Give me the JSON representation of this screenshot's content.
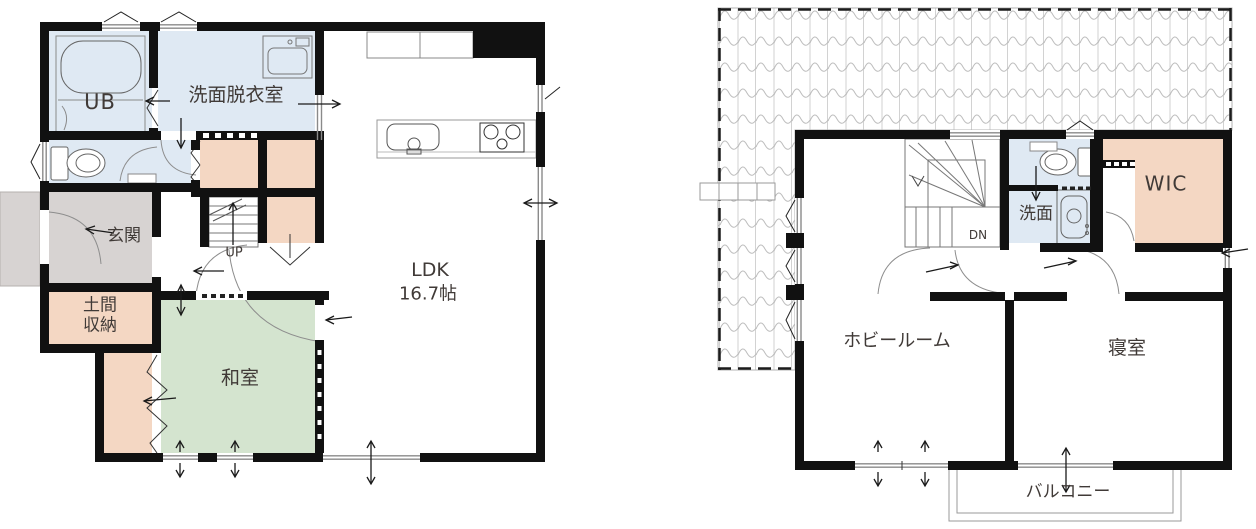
{
  "plan_title": "Two-story house floor plan",
  "colors": {
    "wall": "#111111",
    "water_room_fill": "#dfe9f3",
    "closet_fill": "#f4d7c3",
    "tatami_fill": "#d4e4cf",
    "porch_fill": "#d7d3d2",
    "window_line": "#8a8a8a",
    "roof_line": "#bdbdbd",
    "label_text": "#403a37"
  },
  "floor1": {
    "rooms": {
      "ub": "UB",
      "washroom": "洗面脱衣室",
      "entrance": "玄関",
      "doma_storage": "土間収納",
      "tatami": "和室",
      "ldk": "LDK",
      "ldk_size": "16.7帖",
      "stairs": "UP"
    }
  },
  "floor2": {
    "rooms": {
      "washroom": "洗面",
      "wic": "WIC",
      "hobby": "ホビールーム",
      "bedroom": "寝室",
      "balcony": "バルコニー",
      "stairs": "DN"
    }
  }
}
